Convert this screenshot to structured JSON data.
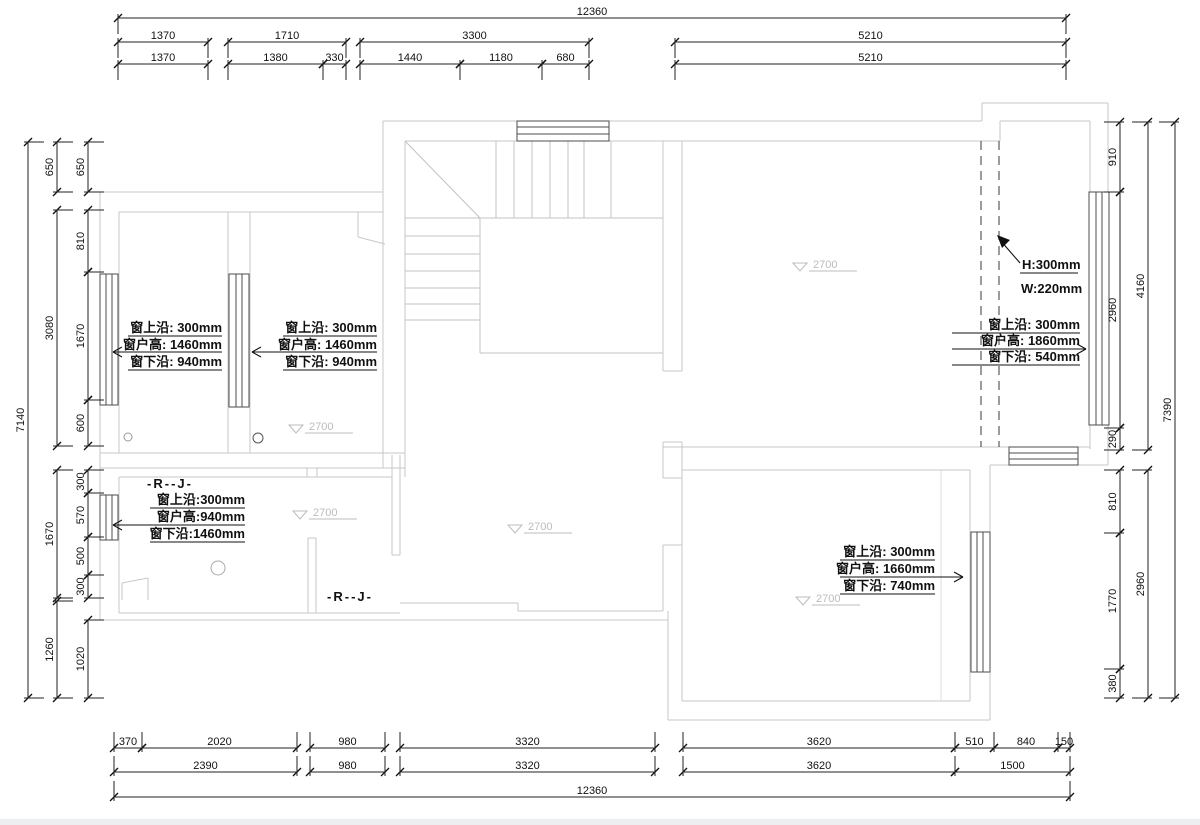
{
  "dims": {
    "top": {
      "overall": "12360",
      "tier2": [
        "1370",
        "1710",
        "3300",
        "5210"
      ],
      "tier3": [
        "1370",
        "1380",
        "330",
        "1440",
        "1180",
        "680",
        "5210"
      ]
    },
    "bottom": {
      "tier1": [
        "370",
        "2020",
        "980",
        "3320",
        "3620",
        "510",
        "840",
        "150"
      ],
      "tier2": [
        "2390",
        "980",
        "3320",
        "3620",
        "1500"
      ],
      "overall": "12360"
    },
    "left": {
      "overall": "7140",
      "mid": [
        "650",
        "3080",
        "1670",
        "1260"
      ],
      "inner": [
        "650",
        "810",
        "1670",
        "600",
        "300",
        "570",
        "500",
        "300",
        "1020"
      ]
    },
    "right": {
      "inner": [
        "910",
        "2960",
        "290",
        "810",
        "1770",
        "380"
      ],
      "mid": [
        "4160",
        "2960"
      ],
      "overall": "7390"
    }
  },
  "annotations": {
    "win_a": {
      "l1": "窗上沿: 300mm",
      "l2": "窗户高: 1460mm",
      "l3": "窗下沿: 940mm"
    },
    "win_b": {
      "l1": "窗上沿: 300mm",
      "l2": "窗户高: 1460mm",
      "l3": "窗下沿: 940mm"
    },
    "win_c": {
      "l1": "窗上沿: 300mm",
      "l2": "窗户高: 1860mm",
      "l3": "窗下沿: 540mm"
    },
    "win_d": {
      "l1": "窗上沿:300mm",
      "l2": "窗户高:940mm",
      "l3": "窗下沿:1460mm"
    },
    "win_e": {
      "l1": "窗上沿: 300mm",
      "l2": "窗户高: 1660mm",
      "l3": "窗下沿: 740mm"
    },
    "beam": {
      "l1": "H:300mm",
      "l2": "W:220mm"
    },
    "rj1": "-R--J-",
    "rj2": "-R--J-",
    "levels": [
      "2700",
      "2700",
      "2700",
      "2700",
      "2700"
    ]
  }
}
